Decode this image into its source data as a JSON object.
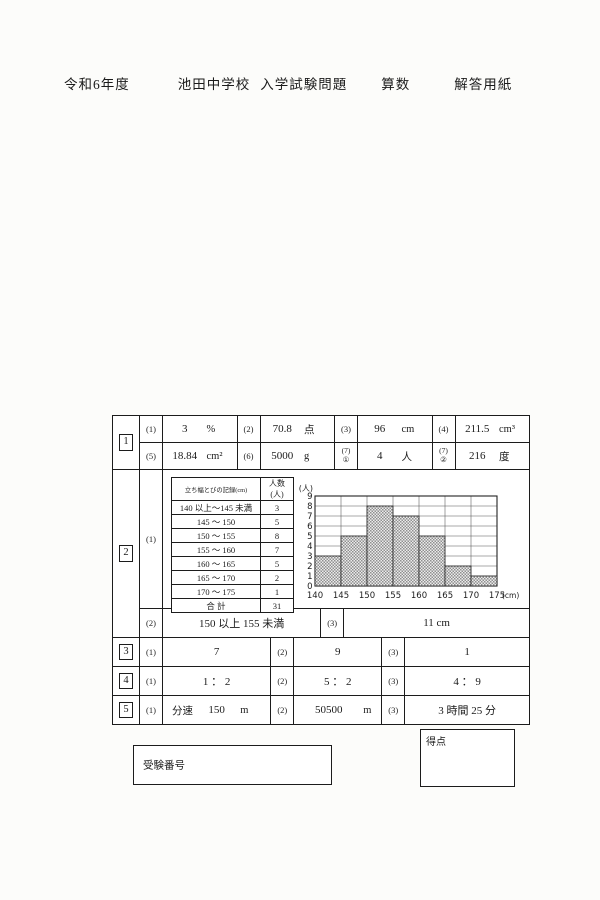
{
  "page": {
    "title_year": "令和6年度",
    "title_school": "池田中学校",
    "title_exam": "入学試験問題",
    "title_subject": "算数",
    "title_sheet": "解答用紙"
  },
  "p1": {
    "num": "1",
    "a1": {
      "no": "(1)",
      "value": "3",
      "unit": "%"
    },
    "a2": {
      "no": "(2)",
      "value": "70.8",
      "unit": "点"
    },
    "a3": {
      "no": "(3)",
      "value": "96",
      "unit": "cm"
    },
    "a4": {
      "no": "(4)",
      "value": "211.5",
      "unit": "cm³"
    },
    "a5": {
      "no": "(5)",
      "value": "18.84",
      "unit": "cm²"
    },
    "a6": {
      "no": "(6)",
      "value": "5000",
      "unit": "g"
    },
    "a7": {
      "no_top": "(7)",
      "no_sub": "①",
      "value": "4",
      "unit": "人"
    },
    "a8": {
      "no_top": "(7)",
      "no_sub": "②",
      "value": "216",
      "unit": "度"
    }
  },
  "p2": {
    "num": "2",
    "sub1": "(1)",
    "freq_table": {
      "header_range": "立ち幅とびの記録(cm)",
      "header_count": "人数(人)",
      "rows": [
        {
          "range": "140 以上～145 未満",
          "count": "3"
        },
        {
          "range": "145 ～ 150",
          "count": "5"
        },
        {
          "range": "150 ～ 155",
          "count": "8"
        },
        {
          "range": "155 ～ 160",
          "count": "7"
        },
        {
          "range": "160 ～ 165",
          "count": "5"
        },
        {
          "range": "165 ～ 170",
          "count": "2"
        },
        {
          "range": "170 ～ 175",
          "count": "1"
        }
      ],
      "total_label": "合 計",
      "total_count": "31"
    },
    "a2": {
      "no": "(2)",
      "value": "150 以上 155 未満"
    },
    "a3": {
      "no": "(3)",
      "value": "11 cm"
    }
  },
  "chart_data": {
    "type": "bar",
    "title": "",
    "categories": [
      "140-145",
      "145-150",
      "150-155",
      "155-160",
      "160-165",
      "165-170",
      "170-175"
    ],
    "values": [
      3,
      5,
      8,
      7,
      5,
      2,
      1
    ],
    "bin_edge_labels": [
      "140",
      "145",
      "150",
      "155",
      "160",
      "165",
      "170",
      "175"
    ],
    "ylabel": "(人)",
    "xlabel": "(cm)",
    "ylim": [
      0,
      9
    ],
    "yticks": [
      0,
      1,
      2,
      3,
      4,
      5,
      6,
      7,
      8,
      9
    ],
    "grid": true,
    "bar_fill": "dotted-hatch"
  },
  "p3": {
    "num": "3",
    "a1": {
      "no": "(1)",
      "value": "7"
    },
    "a2": {
      "no": "(2)",
      "value": "9"
    },
    "a3": {
      "no": "(3)",
      "value": "1"
    }
  },
  "p4": {
    "num": "4",
    "a1": {
      "no": "(1)",
      "value": "1 ： 2"
    },
    "a2": {
      "no": "(2)",
      "value": "5 ： 2"
    },
    "a3": {
      "no": "(3)",
      "value": "4 ： 9"
    }
  },
  "p5": {
    "num": "5",
    "a1": {
      "no": "(1)",
      "prefix": "分速",
      "value": "150",
      "unit": "m"
    },
    "a2": {
      "no": "(2)",
      "value": "50500",
      "unit": "m"
    },
    "a3": {
      "no": "(3)",
      "value": "3 時間 25 分"
    }
  },
  "footer": {
    "examinee_label": "受験番号",
    "score_label": "得点"
  }
}
